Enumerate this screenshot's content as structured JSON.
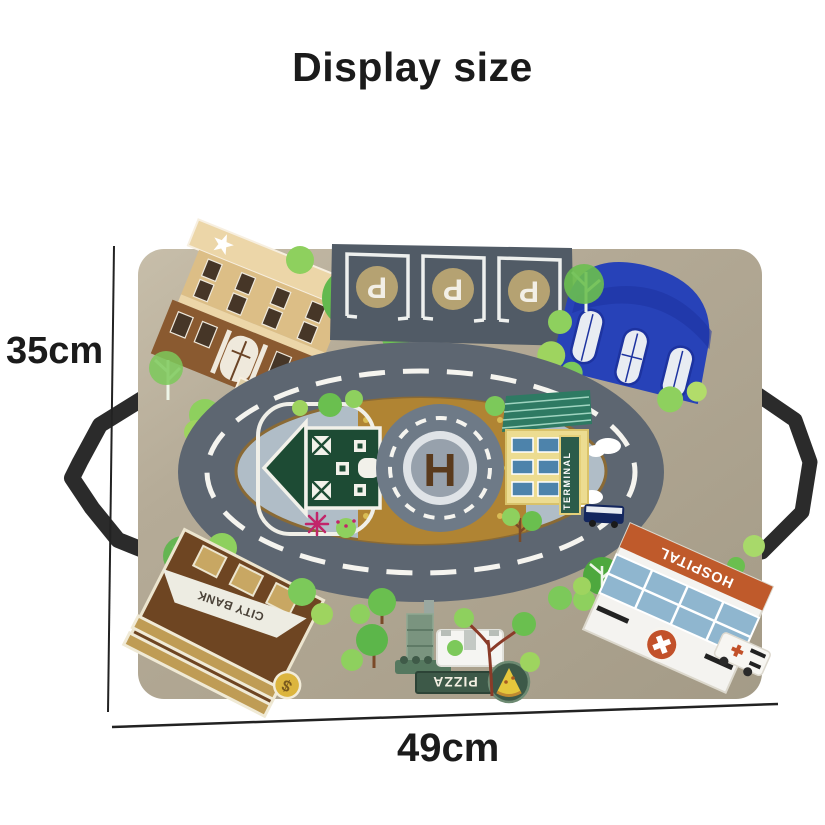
{
  "page": {
    "title": "Display size",
    "height_label": "35cm",
    "width_label": "49cm"
  },
  "mat": {
    "parking_letter": "P",
    "parking_spaces": 3,
    "helipad_letter": "H",
    "bank_sign": "CITY BANK",
    "bank_badge": "$",
    "pizza_sign": "PIZZA",
    "hospital_sign": "HOSPITAL",
    "terminal_sign": "TERMINAL"
  },
  "colors": {
    "background": "#ffffff",
    "mat": "#b3a994",
    "road": "#5d6671",
    "road_marking": "#f5f4ef",
    "island_plaza": "#b0bdc7",
    "island_ground": "#b08433",
    "handle": "#2b2b2b",
    "bank_brown": "#6e4522",
    "pizza_green": "#3d5948",
    "hospital_sign_orange": "#bf5a2b",
    "dome_blue": "#2742b8",
    "barn_green": "#1d4b34",
    "tree_green": "#6abf4f",
    "dimension_line": "#222222"
  }
}
